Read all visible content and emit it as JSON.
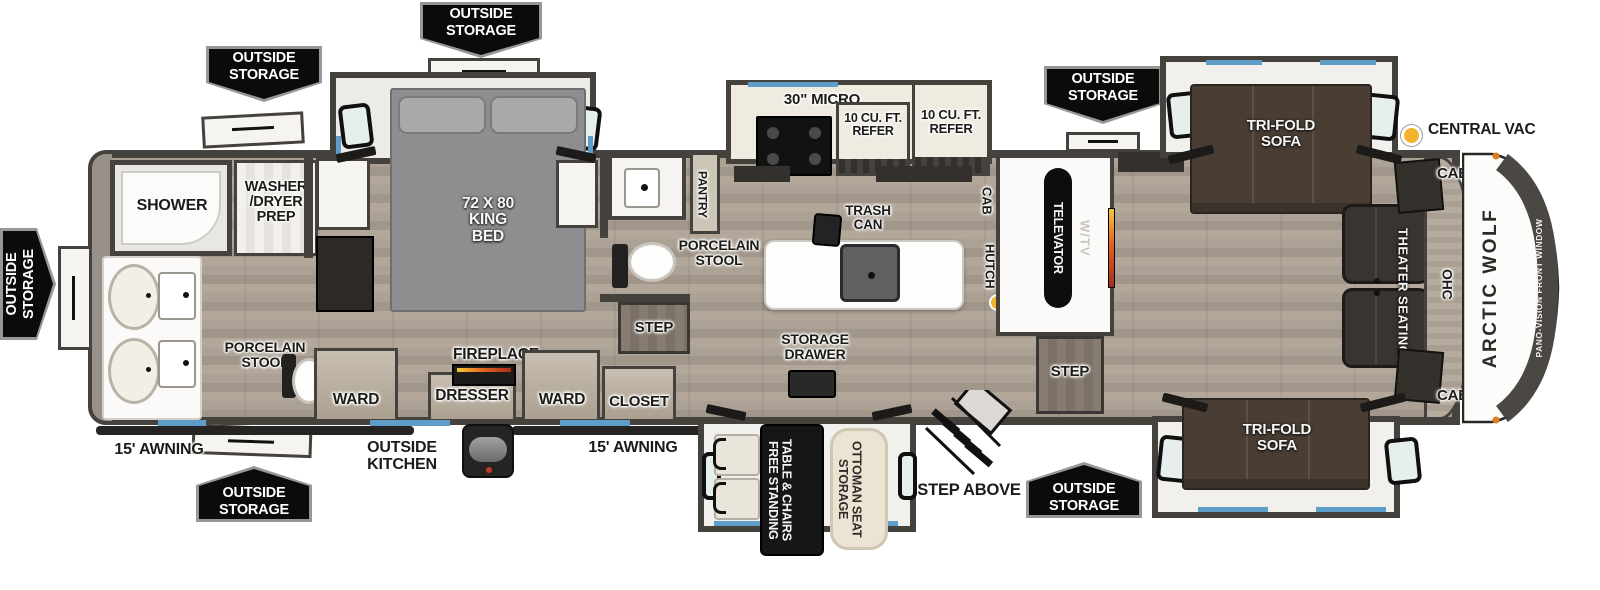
{
  "labels": {
    "outside_storage": "OUTSIDE STORAGE",
    "shower": "SHOWER",
    "washer_dryer_prep": "WASHER /DRYER PREP",
    "porcelain_stool": "PORCELAIN STOOL",
    "ward": "WARD",
    "king_bed": "72 X 80 KING BED",
    "dresser": "DRESSER",
    "fireplace": "FIREPLACE",
    "closet": "CLOSET",
    "step": "STEP",
    "pantry": "PANTRY",
    "micro": "30\" MICRO",
    "refer": "10 CU. FT. REFER",
    "trash_can": "TRASH CAN",
    "cab": "CAB",
    "hutch": "HUTCH",
    "televator": "TELEVATOR",
    "w_tv": "W/TV",
    "storage_drawer": "STORAGE DRAWER",
    "free_standing_table": "FREE STANDING TABLE & CHAIRS",
    "storage_ottoman": "STORAGE OTTOMAN SEAT",
    "tri_fold_sofa": "TRI-FOLD SOFA",
    "theater_seating": "THEATER SEATING",
    "ohc": "OHC",
    "central_vac": "CENTRAL VAC",
    "arctic_wolf": "ARCTIC WOLF",
    "pano_vision": "PANO-VISION FRONT WINDOW",
    "step_above": "STEP ABOVE",
    "outside_kitchen": "OUTSIDE KITCHEN",
    "awning": "15' AWNING"
  },
  "colors": {
    "wall": "#45413c",
    "floor": "#a89e92",
    "accent_blue": "#5f9dc9",
    "badge_bg": "#0b0b0b",
    "sofa_brown": "#4a3e34",
    "bed_gray": "#8e8e90",
    "ottoman_cream": "#ece4d2",
    "vac_yellow": "#f1b42c",
    "fireplace_orange": "#e2631f"
  }
}
